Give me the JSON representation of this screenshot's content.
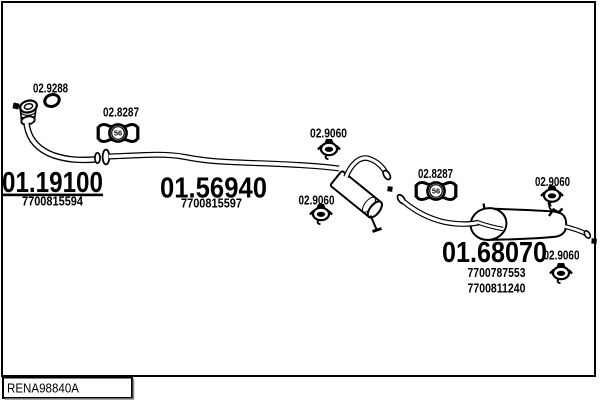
{
  "colors": {
    "ink": "#000000",
    "paper": "#ffffff",
    "shadow": "#8f8f8f"
  },
  "footer": {
    "drawing_code": "RENA98840A"
  },
  "labels": {
    "gasket": "02.9288",
    "clamp_front": "02.8287",
    "clamp_front_size": "56",
    "clamp_rear": "02.8287",
    "clamp_rear_size": "56",
    "hanger_centre_top": "02.9060",
    "hanger_centre_bottom": "02.9060",
    "hanger_rear_top": "02.9060",
    "hanger_tail": "02.9060"
  },
  "parts": {
    "front_pipe": {
      "number": "01.19100",
      "ref": "7700815594"
    },
    "centre_silencer": {
      "number": "01.56940",
      "ref": "7700815597"
    },
    "rear_silencer": {
      "number": "01.68070",
      "ref_1": "7700787553",
      "ref_2": "7700811240"
    }
  }
}
